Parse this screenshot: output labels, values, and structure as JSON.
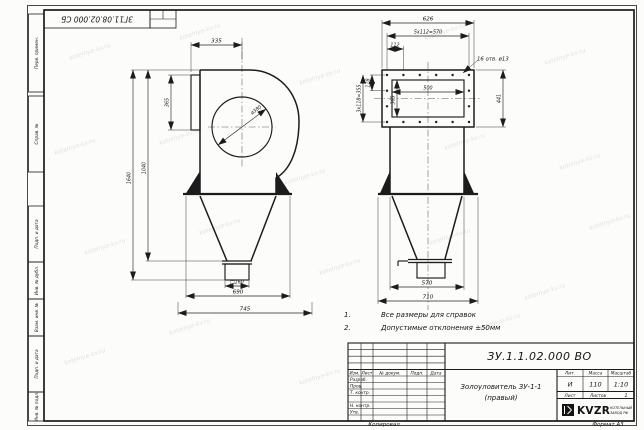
{
  "frame": {
    "corner_stamp": "ЗГ11.08.02.000 СБ",
    "margin_labels": [
      "Перв. примен.",
      "Справ. №",
      "Подп. и дата",
      "Инв. № дубл.",
      "Взам. инв. №",
      "Подп. и дата",
      "Инв. № подл."
    ],
    "copied": "Копировал",
    "format": "Формат А3",
    "watermark": "kotelnye-kv.ru"
  },
  "side_view": {
    "dim_top": "335",
    "dim_inlet_h": "365",
    "dim_total_h": "1640",
    "dim_inner_h": "1040",
    "dim_circle": "ø380",
    "dim_outlet": "□160",
    "dim_base_inner": "690",
    "dim_base_outer": "745"
  },
  "front_view": {
    "dim_width": "626",
    "dim_holes_h": "5x112=570",
    "dim_first": "112",
    "dim_opening_w": "500",
    "dim_opening_h": "365",
    "dim_left_small": "118",
    "dim_holes_v": "3x118=355",
    "dim_height": "441",
    "dim_base_inner": "570",
    "dim_base_outer": "710",
    "holes_note": "16 отв. ø13"
  },
  "notes": {
    "n1_num": "1.",
    "n1_text": "Все размеры для справок",
    "n2_num": "2.",
    "n2_text": "Допустимые отклонения ±50мм"
  },
  "title_block": {
    "doc_number": "ЗУ.1.1.02.000 ВО",
    "title_line1": "Золоуловитель ЗУ-1-1",
    "title_line2": "(правый)",
    "col_izm": "Изм.",
    "col_list": "Лист",
    "col_doc": "№ докум.",
    "col_podp": "Подп.",
    "col_data": "Дата",
    "row_razrab": "Разраб.",
    "row_prov": "Пров.",
    "row_tkontr": "Т. контр.",
    "row_nkontr": "Н. контр.",
    "row_utv": "Утв.",
    "lit_header": "Лит.",
    "mass_header": "Масса",
    "scale_header": "Масштаб",
    "lit_value": "И",
    "mass_value": "110",
    "scale_value": "1:10",
    "sheet_label": "Лист",
    "sheets_label": "Листов",
    "sheets_value": "1",
    "logo": "KVZR",
    "logo_sub1": "КОТЕЛЬНЫЙ",
    "logo_sub2": "ЗАВОД РФ"
  }
}
